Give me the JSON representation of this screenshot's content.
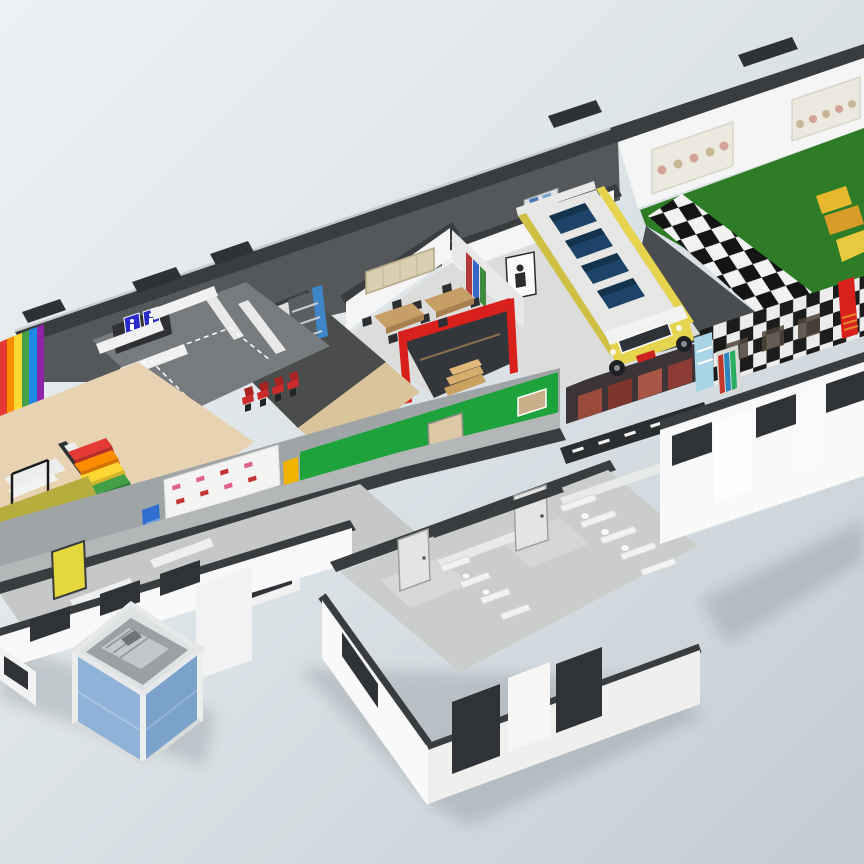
{
  "meta": {
    "view": "isometric-cutaway-3d-floorplan"
  },
  "palette": {
    "bg_top": "#eef1f3",
    "bg_mid": "#dde4e8",
    "bg_bottom": "#c3ccd3",
    "roof_dark": "#3a3d40",
    "wall_zone_gray": "#55585b",
    "wall_white": "#f4f5f4",
    "wall_light": "#eceded",
    "floor_gray": "#dcdddb",
    "corridor_floor": "#b4b7b8",
    "tan_floor": "#e7d2b2",
    "tan_strip": "#d9c49c",
    "carpet_dark": "#4b4d4d",
    "wc_floor": "#787b7e",
    "annex_floor": "#cbcdcb",
    "exterior_white": "#f8f9f8",
    "green_floor": "#2e7d26",
    "green_wall": "#1ea33c",
    "checker_black": "#141414",
    "checker_white": "#f2f2f2",
    "bus_yellow": "#e6d44f",
    "bus_yellow_dark": "#cfc043",
    "seat_navy": "#1d4468",
    "seat_navy_dark": "#14334d",
    "windshield": "#2f3338",
    "red_accent": "#d8201d",
    "red_chair": "#cc2b2b",
    "wood": "#c79e66",
    "wood_dark": "#a87f4e",
    "board_tan": "#d9cdb2",
    "door_tan": "#dcc9a4",
    "door_yellow": "#e5d83c",
    "pillar_yellow": "#f0b400",
    "pillar_stripe": "#c24a00",
    "banner_blue": "#2f6fd0",
    "banner_cyan": "#a8d4e6",
    "poster_white": "#f4f4f2",
    "poster_pink": "#e06090",
    "poster_red": "#c23333",
    "sign_blue": "#2a2ac8",
    "olive_wall": "#b5ad3e",
    "rainbow_red": "#e53935",
    "rainbow_orange": "#fb8c00",
    "rainbow_yellow": "#fdd835",
    "rainbow_green": "#43a047",
    "rainbow_blue": "#1e88e5",
    "rainbow_purple": "#8e24aa",
    "lift_blue_light": "#8fb3d8",
    "lift_blue_dark": "#7aa2cb",
    "lift_frame": "#eceeee",
    "window_dark": "#2f3338",
    "shadow": "#5a646c"
  },
  "scene": {
    "areas": [
      {
        "name": "activity-hall",
        "floor": "green",
        "walkway": "black-white-checker",
        "wall_poster_panels": 2
      },
      {
        "name": "bus-play-room",
        "feature": "yellow-play-bus",
        "seat_rows": 4
      },
      {
        "name": "classroom",
        "tables": 2,
        "chairs_per_table": 4,
        "feature": "red-play-shopfront",
        "steps": 3
      },
      {
        "name": "reading-room",
        "floor": "dark-carpet",
        "red_chairs": 4,
        "feature": "bookshelf-blue-panel"
      },
      {
        "name": "early-years-room",
        "rainbow_wall_stripes": 6,
        "rainbow_stair_steps": 5
      },
      {
        "name": "wc-area-north",
        "blue_door_signs": 2
      },
      {
        "name": "central-corridor",
        "features": [
          "green-wall",
          "wood-door",
          "poster-board",
          "blue-banner",
          "cyan-banner",
          "striped-pillar",
          "exhibit-posters",
          "checkered-photo-wall",
          "red-banner",
          "road-markings"
        ]
      },
      {
        "name": "toilet-block-annex",
        "cubicle_partitions": 9,
        "doors": 2,
        "exterior_windows": 3
      },
      {
        "name": "service-lift",
        "panel_color": "blue"
      }
    ]
  }
}
